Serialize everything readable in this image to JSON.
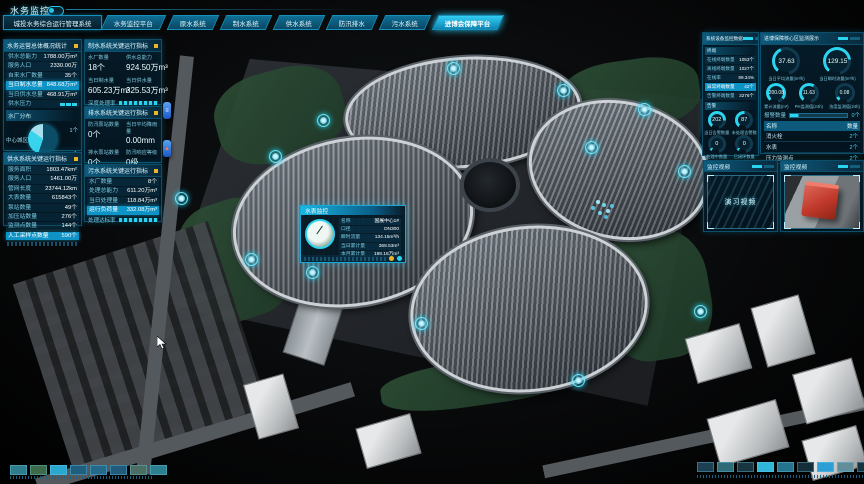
{
  "colors": {
    "accent": "#29c3e8",
    "highlight_row": "#0e93c6",
    "warn_dot": "#f0b429",
    "pin_blue": "#1b55c8",
    "pie_slices": [
      "#0b4c66",
      "#38d3ec",
      "#a8dfec"
    ]
  },
  "header": {
    "brand": "水务监控",
    "system_title": "城投水务综合运行管理系统",
    "tabs": [
      {
        "label": "水务监控平台",
        "active": false
      },
      {
        "label": "原水系统",
        "active": false
      },
      {
        "label": "制水系统",
        "active": false
      },
      {
        "label": "供水系统",
        "active": false
      },
      {
        "label": "防汛排水",
        "active": false
      },
      {
        "label": "污水系统",
        "active": false
      },
      {
        "label": "进博会保障平台",
        "active": true
      }
    ]
  },
  "overview_panel": {
    "title": "水务运营总体概况统计",
    "rows": [
      {
        "label": "供水总能力",
        "value": "1788.00万m³"
      },
      {
        "label": "服务人口",
        "value": "2330.00万"
      },
      {
        "label": "自来水厂数量",
        "value": "35个"
      },
      {
        "label": "当日制水总量",
        "value": "848.68万m³"
      },
      {
        "label": "当日供水总量",
        "value": "468.91万m³"
      },
      {
        "label": "供水压力",
        "value": ""
      }
    ],
    "pie_section": {
      "label": "水厂分布",
      "legend_left": "中心城区",
      "callout_top": "1个",
      "callout_bottom": "2个",
      "slices": [
        {
          "name": "中心城区",
          "value": 55
        },
        {
          "name": "1个",
          "value": 30
        },
        {
          "name": "2个",
          "value": 15
        }
      ]
    }
  },
  "supply_panel": {
    "title": "供水系统关键运行指标",
    "rows": [
      {
        "label": "服务面积",
        "value": "1803.47km²"
      },
      {
        "label": "服务人口",
        "value": "1461.00万"
      },
      {
        "label": "管网长度",
        "value": "23744.12km"
      },
      {
        "label": "大表数量",
        "value": "615843个"
      },
      {
        "label": "泵站数量",
        "value": "49个"
      },
      {
        "label": "加压站数量",
        "value": "276个"
      },
      {
        "label": "监测点数量",
        "value": "144个"
      },
      {
        "label": "人工采样点数量",
        "value": "590个"
      }
    ]
  },
  "production_panel": {
    "title": "制水系统关键运行指标",
    "stats": [
      {
        "label": "水厂数量",
        "value": "18个"
      },
      {
        "label": "供水总能力",
        "value": "924.50万m³"
      },
      {
        "label": "当日制水量",
        "value": "605.23万m³"
      },
      {
        "label": "当日供水量",
        "value": "325.53万m³"
      }
    ],
    "bar_label": "深度处理率"
  },
  "drainage_panel": {
    "title": "排水系统关键运行指标",
    "stats": [
      {
        "label": "防汛泵站数量",
        "value": "0个"
      },
      {
        "label": "当日平均降雨量",
        "value": "0.00mm"
      },
      {
        "label": "排水泵站数量",
        "value": "0个"
      },
      {
        "label": "防汛响应等级",
        "value": "0级"
      }
    ]
  },
  "sewage_panel": {
    "title": "污水系统关键运行指标",
    "rows": [
      {
        "label": "水厂数量",
        "value": "8个"
      },
      {
        "label": "处理总能力",
        "value": "611.20万m³"
      },
      {
        "label": "当日处理量",
        "value": "118.84万m³"
      },
      {
        "label": "运行负荷量",
        "value": "332.08万m³"
      }
    ],
    "bar_label": "处理达标率"
  },
  "device_panel": {
    "title": "系统设备监控数据",
    "section_terminal": "终端",
    "rows": [
      {
        "label": "在线终端数量",
        "value": "1053个"
      },
      {
        "label": "离线终端数量",
        "value": "1027个"
      },
      {
        "label": "在线率",
        "value": "99.34%"
      },
      {
        "label": "异常终端数量",
        "value": "42个"
      },
      {
        "label": "告警终端数量",
        "value": "3276个"
      }
    ],
    "section_alarm": "告警",
    "gauges": [
      {
        "value": "202",
        "label": "当日告警数量"
      },
      {
        "value": "87",
        "label": "未处理告警数"
      },
      {
        "value": "0",
        "label": "处理中数量"
      },
      {
        "value": "0",
        "label": "已闭环数量"
      }
    ]
  },
  "expo_panel": {
    "title": "进博保障核心区监测展示",
    "big_gauges": [
      {
        "value": "37.63",
        "label": "当日平均流量(m³/h)"
      },
      {
        "value": "129.15",
        "label": "当日瞬时流量(m³/h)"
      }
    ],
    "small_gauges": [
      {
        "value": "200.08",
        "label": "累计流量(m³)"
      },
      {
        "value": "11.63",
        "label": "PH监测值(24h)"
      },
      {
        "value": "0.08",
        "label": "浊度监测值(24h)"
      }
    ],
    "alarm": {
      "label": "报警数量",
      "value": "0个"
    },
    "table": {
      "headers": [
        "名称",
        "数量"
      ],
      "rows": [
        {
          "name": "消火栓",
          "count": "2个"
        },
        {
          "name": "水表",
          "count": "2个"
        },
        {
          "name": "压力监测点",
          "count": "2个"
        }
      ]
    }
  },
  "videos": {
    "left": {
      "title": "监控视频",
      "caption": "演习视频"
    },
    "right": {
      "title": "监控视频"
    }
  },
  "popup": {
    "title": "水表监控",
    "rows": [
      {
        "label": "名称",
        "value": "国展中心1#"
      },
      {
        "label": "口径",
        "value": "DN300"
      },
      {
        "label": "瞬时流量",
        "value": "134.15m³/h"
      },
      {
        "label": "当日累计量",
        "value": "368.53m³"
      },
      {
        "label": "本月累计量",
        "value": "198.18万m³"
      }
    ]
  },
  "legend": {
    "bottom_left": [
      {
        "style": "background:#2f7d8c"
      },
      {
        "style": "background:#3d6b4a"
      },
      {
        "style": "background:#29a7cf"
      },
      {
        "style": "background:#1f5f7e"
      },
      {
        "style": "background:#24688a"
      },
      {
        "style": "background:#215a7a"
      },
      {
        "style": "background:#4a6e62"
      },
      {
        "style": "background:#2d7f90"
      }
    ],
    "bottom_right": [
      {
        "style": "background:#1d3f52"
      },
      {
        "style": "background:#2e6a78"
      },
      {
        "style": "background:#173642"
      },
      {
        "style": "background:#2fb6d9"
      },
      {
        "style": "background:#25748f"
      },
      {
        "style": "background:#142e3a"
      },
      {
        "style": "background:#2e9fd4"
      },
      {
        "style": "background:#628e9a"
      },
      {
        "style": "background:#16333f"
      },
      {
        "style": "background:#93a3a8"
      }
    ]
  }
}
